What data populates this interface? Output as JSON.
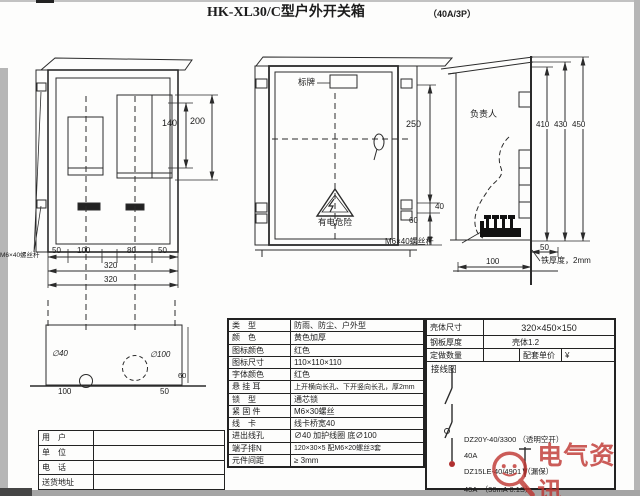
{
  "title": {
    "main": "HK-XL30/C型户外开关箱",
    "sub": "（40A/3P）"
  },
  "colors": {
    "line": "#2b2b2b",
    "accent_red": "#b03030",
    "watermark_red": "#bf3430"
  },
  "front_view": {
    "bolt_label": "M6×40螺丝杆",
    "dims": {
      "d140": "140",
      "d200": "200",
      "w1": "50",
      "w2": "100",
      "w3": "80",
      "w4": "50",
      "total1": "320",
      "total2": "320"
    }
  },
  "plan_view": {
    "hole_small": "∅40",
    "hole_large": "∅100",
    "w_left": "100",
    "w_right": "50",
    "height": "60"
  },
  "door_view": {
    "nameplate": "标牌",
    "danger": "有电危险",
    "bolt_label": "M6×40螺丝杆",
    "dims": {
      "d250": "250",
      "d40": "40",
      "d60": "60"
    }
  },
  "side_view": {
    "person": "负责人",
    "thickness_note": "铁厚度，2mm",
    "dims": {
      "d410": "410",
      "d430": "430",
      "d450": "450",
      "d50": "50",
      "d100": "100"
    }
  },
  "spec_table": {
    "rows": [
      {
        "label": "类　型",
        "value": "防雨、防尘、户外型"
      },
      {
        "label": "颜　色",
        "value": "黄色加厚"
      },
      {
        "label": "图标颜色",
        "value": "红色"
      },
      {
        "label": "图标尺寸",
        "value": "110×110×110"
      },
      {
        "label": "字体颜色",
        "value": "红色"
      },
      {
        "label": "悬 挂 耳",
        "value": "上开横向长孔、下开竖向长孔，厚2mm"
      },
      {
        "label": "锁　型",
        "value": "通芯锁"
      },
      {
        "label": "紧 固 件",
        "value": "M6×30螺丝"
      },
      {
        "label": "线　卡",
        "value": "线卡桥宽40"
      },
      {
        "label": "进出线孔",
        "value": "∅40 加护线圈 底∅100"
      },
      {
        "label": "端子排N",
        "value": "120×30×5 配M6×20螺丝3套"
      },
      {
        "label": "元件间距",
        "value": "≥ 3mm"
      }
    ]
  },
  "shell_table": {
    "rows": [
      {
        "label": "壳体尺寸",
        "value": "320×450×150"
      },
      {
        "label": "钢板厚度",
        "value": "壳体1.2"
      }
    ],
    "order_row": {
      "qty_label": "定做数量",
      "qty_value": "",
      "price_label": "配套单价",
      "price_value": "¥"
    }
  },
  "wiring": {
    "title": "接线图",
    "breaker1_model": "DZ20Y-40/3300 （透明空开）",
    "breaker1_rating": "40A",
    "breaker2_model": "DZ15LE-40/4901 （漏保）",
    "breaker2_rating": "40A　（30mA 0.1S）"
  },
  "customer_table": {
    "rows": [
      {
        "label": "用　户",
        "value": ""
      },
      {
        "label": "单　位",
        "value": ""
      },
      {
        "label": "电　话",
        "value": ""
      },
      {
        "label": "送货地址",
        "value": ""
      }
    ]
  },
  "watermark": {
    "text": "电气资讯"
  }
}
